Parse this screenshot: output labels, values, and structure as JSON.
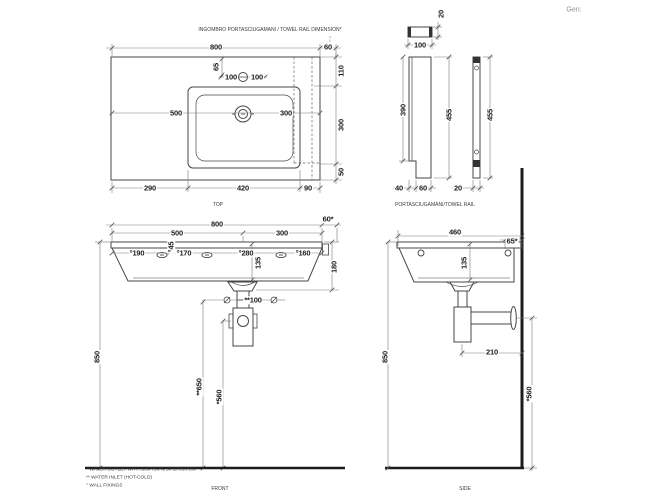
{
  "gen_label": "Gen:",
  "top_view": {
    "note": "INGOMBRO PORTASCIUGAMANI / TOWEL RAIL DIMENSION*",
    "label": "TOP",
    "width": "800",
    "rail_side": "60",
    "depth_top": "110",
    "basin_depth": "300",
    "depth_bottom": "50",
    "faucet_offset": "65",
    "faucet_left": "100",
    "faucet_right": "100",
    "basin_left": "500",
    "basin_right": "300",
    "left_margin": "290",
    "basin_width": "420",
    "right_margin": "90"
  },
  "towel_rail": {
    "label": "PORTASCIUGAMANI/TOWEL RAIL",
    "bar_width": "100",
    "bar_thickness": "20",
    "inner_height": "390",
    "height_front": "455",
    "height_side": "455",
    "foot_offset": "40",
    "foot_width": "60",
    "profile_thickness": "20"
  },
  "front_view": {
    "label": "FRONT",
    "width": "800",
    "rail_overhang": "60*",
    "drain_left": "500",
    "drain_right": "300",
    "fix_1": "°190",
    "fix_2": "°170",
    "fix_3": "°280",
    "fix_4": "°160",
    "fix_depth": "°45",
    "basin_height": "135",
    "front_height": "180",
    "inlet_span": "**100",
    "rim_height": "850",
    "inlet_height": "**650",
    "outlet_height": "*560",
    "notes": [
      "* WATER OUTLET WITH SISP/SIFN/SIFBR/SIFCM",
      "** WATER INLET  (HOT-COLD)",
      "° WALL FIXINGS"
    ]
  },
  "side_view": {
    "label": "SIDE",
    "depth": "460",
    "rail_gap": "65*",
    "basin_height": "135",
    "rim_height": "850",
    "trap_offset": "210",
    "outlet_height": "*560"
  }
}
